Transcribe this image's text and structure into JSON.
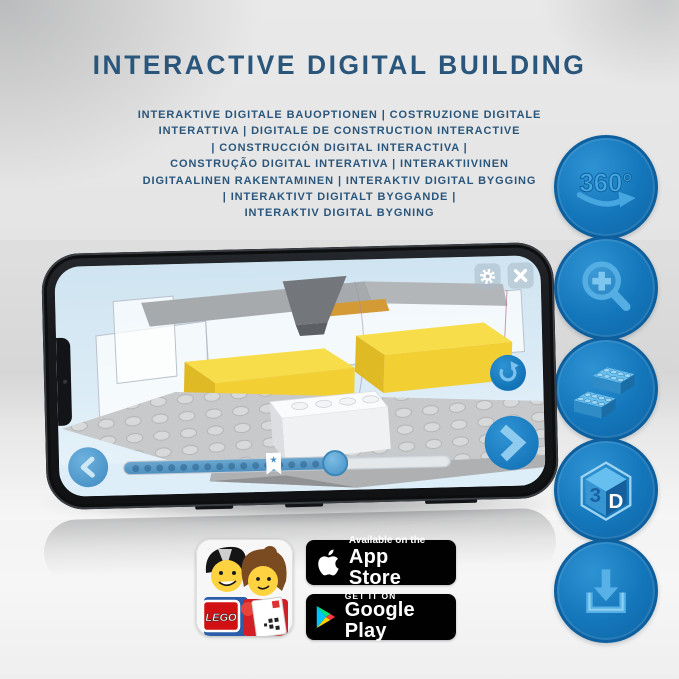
{
  "header": {
    "title": "INTERACTIVE DIGITAL BUILDING",
    "subtitle_lines": [
      "INTERAKTIVE DIGITALE BAUOPTIONEN | COSTRUZIONE DIGITALE",
      "INTERATTIVA | DIGITALE DE CONSTRUCTION INTERACTIVE",
      "| CONSTRUCCIÓN DIGITAL INTERACTIVA |",
      "CONSTRUÇÃO DIGITAL INTERATIVA | INTERAKTIIVINEN",
      "DIGITAALINEN RAKENTAMINEN | INTERAKTIV DIGITAL BYGGING",
      "| INTERAKTIVT DIGITALT BYGGANDE |",
      "INTERAKTIV DIGITAL BYGNING"
    ]
  },
  "feature_rail": {
    "rotation_label": "360°",
    "cube_left": "3",
    "cube_right": "D",
    "icons": [
      "rotate-360-icon",
      "zoom-in-magnifier-icon",
      "lego-bricks-icon",
      "3d-cube-icon",
      "download-icon"
    ]
  },
  "phone": {
    "app_ui": {
      "top_buttons": [
        "settings-gear",
        "close"
      ],
      "side_button": "rotate-reset",
      "nav_buttons": [
        "previous-step",
        "next-step"
      ],
      "slider": {
        "steps_shown": 16,
        "progress_percent": 64,
        "bookmark_percent": 45,
        "bookmark_glyph": "★"
      }
    }
  },
  "store_badges": {
    "app_store": {
      "tagline": "Available on the",
      "store_name": "App Store",
      "logo": "apple-logo"
    },
    "google_play": {
      "tagline": "GET IT ON",
      "store_name": "Google Play",
      "logo": "google-play-logo"
    },
    "app_icon": {
      "logo_text": "LEGO"
    }
  },
  "colors": {
    "title_blue": "#2a567c",
    "circle_blue": "#1173b6",
    "icon_light_blue": "#4fa9e0",
    "lego_yellow": "#f2d23e",
    "app_ui_blue": "#1e83c8",
    "badge_black": "#010101"
  }
}
